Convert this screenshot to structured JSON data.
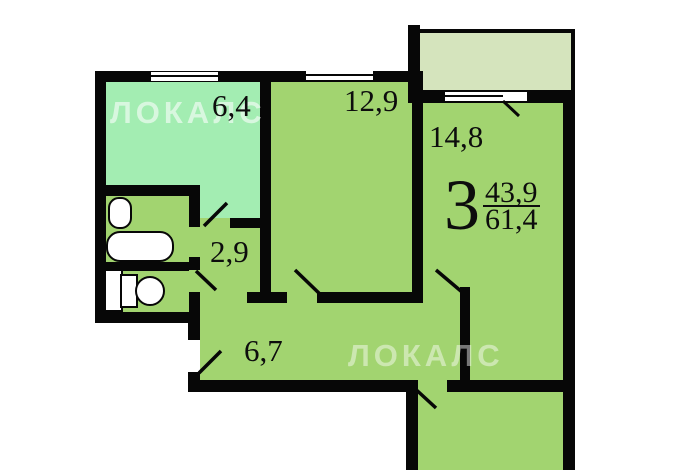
{
  "plan_type": "apartment-floor-plan",
  "watermarks": {
    "top_left": "ЛОКАЛС",
    "bottom_right": "ЛОКАЛС"
  },
  "apartment": {
    "rooms_count": "3",
    "living_area": "43,9",
    "total_area": "61,4"
  },
  "labels": {
    "kitchen": "6,4",
    "room_top_middle": "12,9",
    "room_right": "14,8",
    "hallway": "2,9",
    "corridor": "6,7"
  },
  "colors": {
    "room_fill": "#a2d470",
    "kitchen_fill": "#a3edb2",
    "balcony_fill": "#d5e4bd",
    "wall": "#070707",
    "fixture_fill": "#ffffff",
    "label_text": "#0d0d0d"
  },
  "icons": [
    "bathtub-icon",
    "sink-icon",
    "toilet-icon",
    "window-icon",
    "door-swing-icon"
  ]
}
